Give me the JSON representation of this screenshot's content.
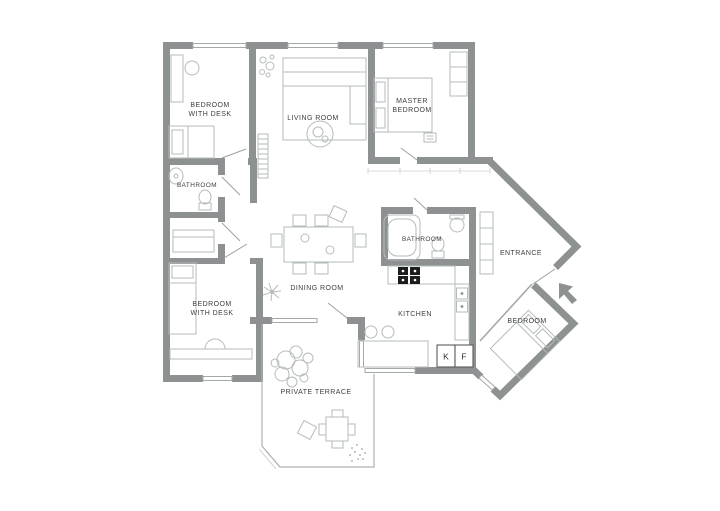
{
  "plan": {
    "title": "apartment-floor-plan",
    "rooms": {
      "bedroom_desk_top": {
        "line1": "BEDROOM",
        "line2": "WITH DESK"
      },
      "living": {
        "label": "LIVING ROOM"
      },
      "master": {
        "line1": "MASTER",
        "line2": "BEDROOM"
      },
      "bathroom_left": {
        "label": "BATHROOM"
      },
      "bedroom_desk_bottom": {
        "line1": "BEDROOM",
        "line2": "WITH DESK"
      },
      "dining": {
        "label": "DINING ROOM"
      },
      "bathroom_right": {
        "label": "BATHROOM"
      },
      "entrance": {
        "label": "ENTRANCE"
      },
      "kitchen": {
        "label": "KITCHEN"
      },
      "bedroom_right": {
        "label": "BEDROOM"
      },
      "terrace": {
        "label": "PRIVATE TERRACE"
      }
    },
    "appliances": {
      "k": "K",
      "f": "F"
    },
    "colors": {
      "wall": "#8e9191",
      "furniture": "#b5bbbb",
      "text": "#3d3f3f",
      "stove": "#1c1c1c",
      "background": "#ffffff"
    }
  }
}
